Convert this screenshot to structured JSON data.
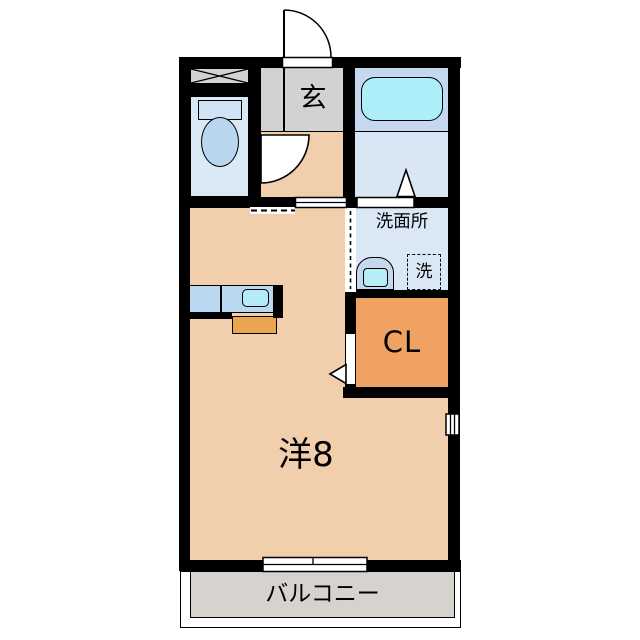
{
  "plan": {
    "entrance": {
      "label": "玄"
    },
    "washroom": {
      "label": "洗面所"
    },
    "laundry": {
      "label": "洗"
    },
    "closet": {
      "label": "CL"
    },
    "main_room": {
      "label": "洋8"
    },
    "balcony": {
      "label": "バルコニー"
    }
  },
  "colors": {
    "wall": "#000000",
    "room": "#f2cfac",
    "entrance-gray": "#d2d2d2",
    "toilet-room": "#d9e9f6",
    "toilet-tank": "#cfe3f4",
    "toilet-fixture": "#b9d6f0",
    "bath-upper": "#c4d9f0",
    "bath-floor": "#d9e7f5",
    "bathtub": "#adeff8",
    "washroom": "#dae8f6",
    "washbasin": "#c6d9ec",
    "washbasin-inner": "#b5eef6",
    "closet": "#efa261",
    "counter": "#b9d8f2",
    "sink": "#b3ecf6",
    "stove": "#eaa54e",
    "balcony": "#d6d2cd"
  }
}
